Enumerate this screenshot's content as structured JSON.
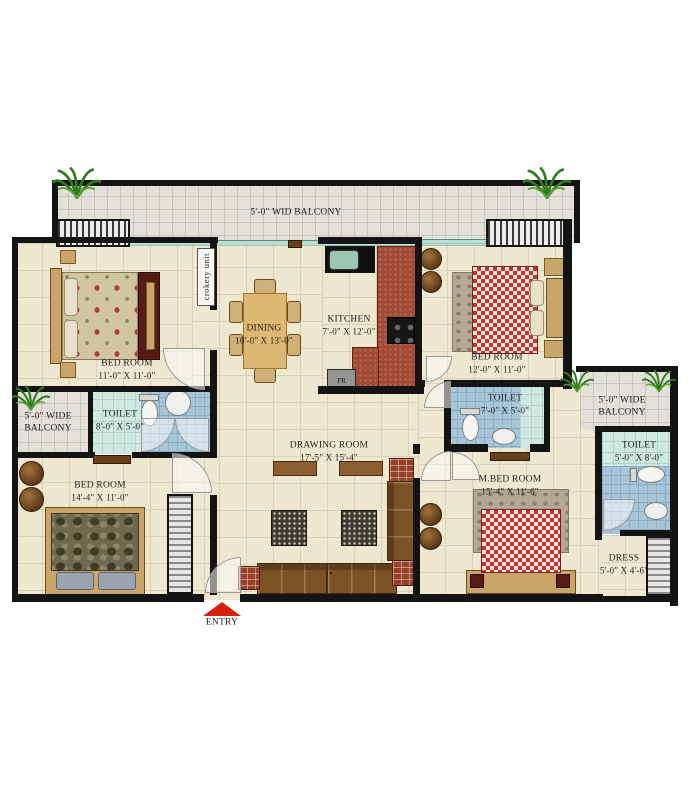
{
  "floor_plan": {
    "entry": {
      "label": "ENTRY"
    },
    "balconies": {
      "top": {
        "label": "5'-0\" WID BALCONY"
      },
      "left": {
        "line1": "5'-0\" WIDE",
        "line2": "BALCONY"
      },
      "right": {
        "line1": "5'-0\" WIDE",
        "line2": "BALCONY"
      }
    },
    "kitchen_items": {
      "fridge": "FR",
      "crockery_unit": "crokery unit"
    },
    "rooms": {
      "bedroom_top_left": {
        "name": "BED ROOM",
        "dims": "11'-0\" X 11'-0\""
      },
      "bedroom_top_right": {
        "name": "BED ROOM",
        "dims": "12'-0\" X 11'-0\""
      },
      "bedroom_bottom_left": {
        "name": "BED ROOM",
        "dims": "14'-4\" X 11'-0\""
      },
      "master_bedroom": {
        "name": "M.BED ROOM",
        "dims": "15'-4\" X 11'-6\""
      },
      "dining": {
        "name": "DINING",
        "dims": "10'-0\" X 13'-0\""
      },
      "kitchen": {
        "name": "KITCHEN",
        "dims": "7'-0\" X 12'-0\""
      },
      "drawing_room": {
        "name": "DRAWING ROOM",
        "dims": "17'-5\" X 15'-4\""
      },
      "toilet_left": {
        "name": "TOILET",
        "dims": "8'-0\" X 5'-0\""
      },
      "toilet_middle": {
        "name": "TOILET",
        "dims": "7'-0\" X 5'-0\""
      },
      "toilet_right": {
        "name": "TOILET",
        "dims": "5'-0\" X 8'-0\""
      },
      "dress": {
        "name": "DRESS",
        "dims": "5'-0\" X 4'-6\""
      }
    },
    "colors": {
      "wall": "#141414",
      "room_floor": "#efe8d1",
      "balcony_floor": "#e3e0da",
      "toilet_tile_blue": "#a9c6d9",
      "shower_tile_cyan": "#cfe9e2",
      "kitchen_counter_red": "#a34a35",
      "sofa_brown": "#7c5124",
      "entry_arrow_red": "#d6200a",
      "plant_green": "#2e7c1c"
    }
  }
}
